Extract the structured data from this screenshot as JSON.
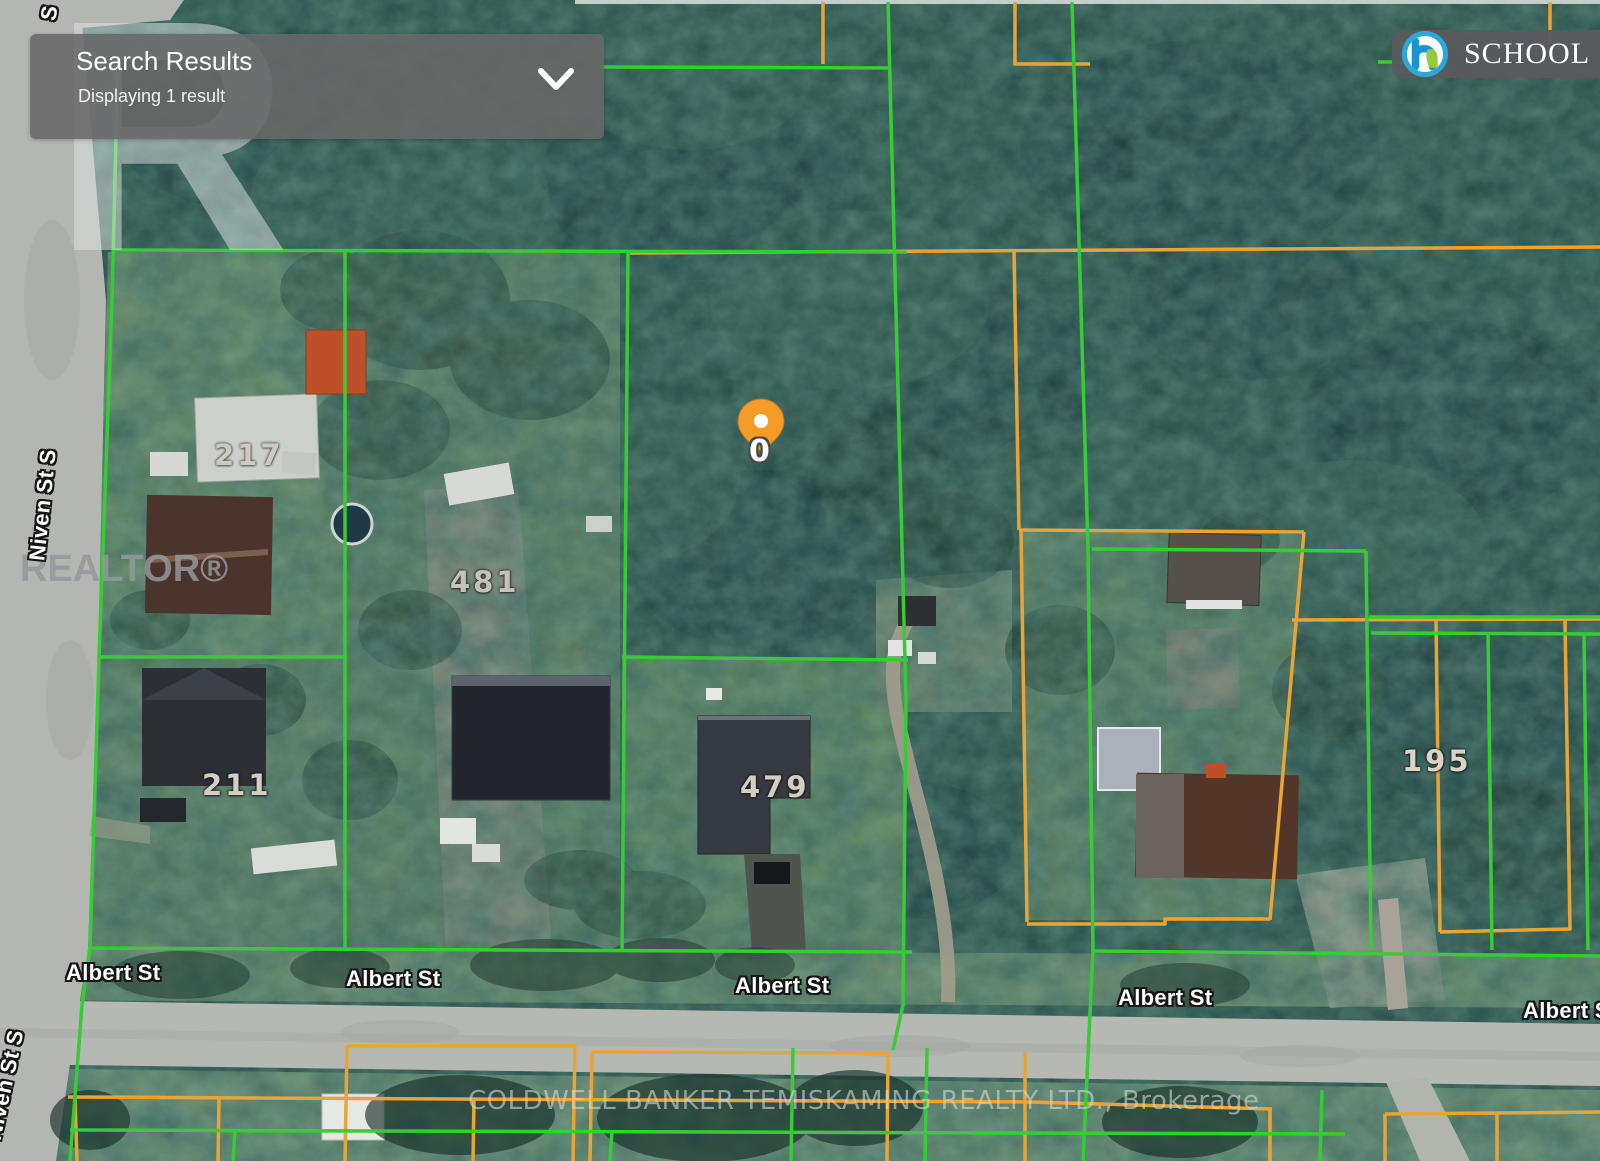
{
  "search_panel": {
    "title": "Search Results",
    "subtitle": "Displaying 1 result"
  },
  "school_chip": {
    "label": "SCHOOL"
  },
  "realtor_watermark": {
    "logo_letter": "R",
    "label": "REALTOR®"
  },
  "brokerage_watermark": "COLDWELL BANKER TEMISKAMING REALTY LTD., Brokerage",
  "map": {
    "pin": {
      "label": "0"
    },
    "street_labels": {
      "albert_1": "Albert St",
      "albert_2": "Albert St",
      "albert_3": "Albert St",
      "albert_4": "Albert St",
      "albert_5": "Albert St",
      "niven_1": "Niven St S",
      "niven_2": "Niven St S",
      "fragment_top": "S"
    },
    "house_numbers": {
      "n217": "217",
      "n481": "481",
      "n211": "211",
      "n479": "479",
      "n195": "195"
    },
    "colors": {
      "parcel_green": "#36cc33",
      "parcel_orange": "#eaa435",
      "pin": "#f59b28"
    }
  }
}
